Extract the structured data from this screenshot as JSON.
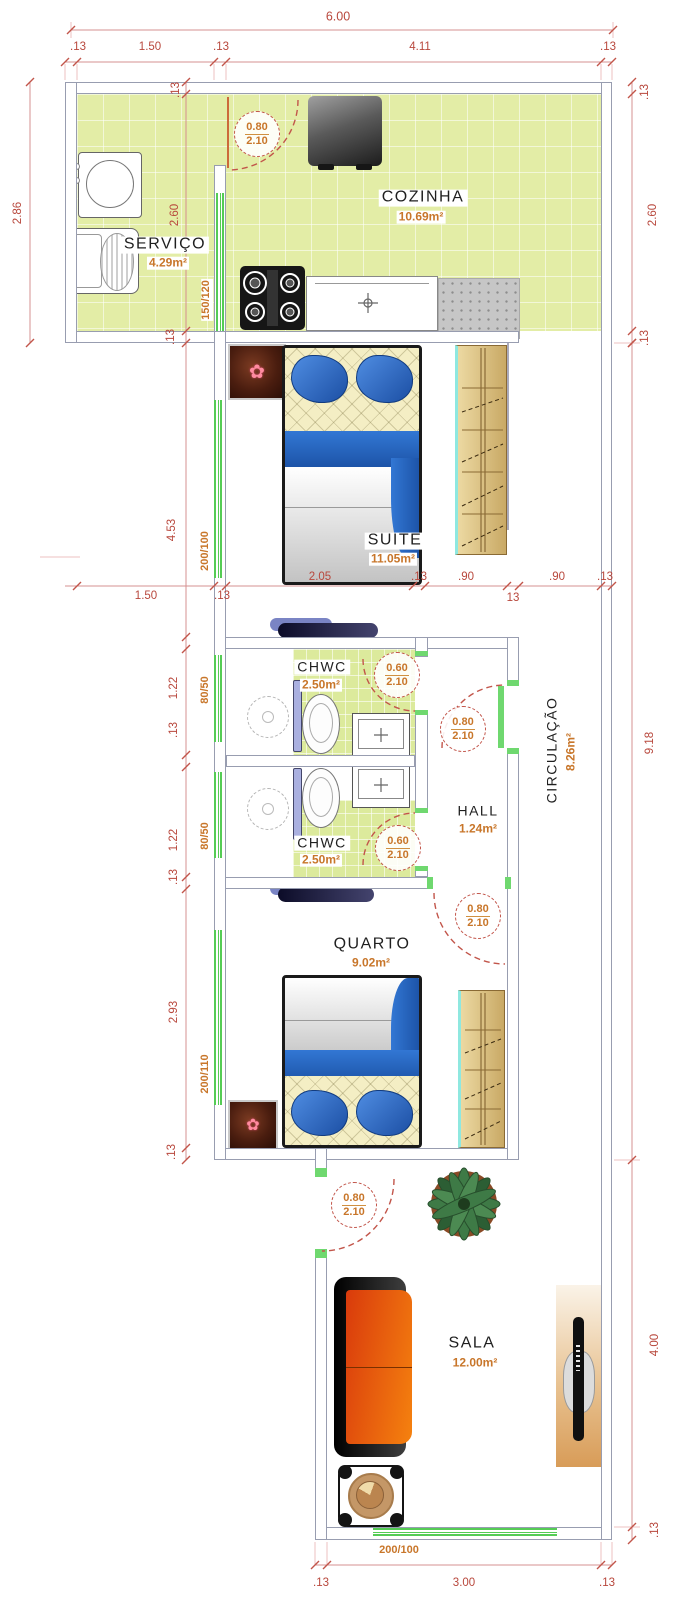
{
  "rooms": {
    "servico": {
      "name": "SERVIÇO",
      "area": "4.29m²"
    },
    "cozinha": {
      "name": "COZINHA",
      "area": "10.69m²"
    },
    "suite": {
      "name": "SUITE",
      "area": "11.05m²"
    },
    "chwc1": {
      "name": "CHWC",
      "area": "2.50m²"
    },
    "chwc2": {
      "name": "CHWC",
      "area": "2.50m²"
    },
    "hall": {
      "name": "HALL",
      "area": "1.24m²"
    },
    "circulacao": {
      "name": "CIRCULAÇÃO",
      "area": "8.26m²"
    },
    "quarto": {
      "name": "QUARTO",
      "area": "9.02m²"
    },
    "sala": {
      "name": "SALA",
      "area": "12.00m²"
    }
  },
  "doors": {
    "kitchen": {
      "w": "0.80",
      "h": "2.10"
    },
    "chwc1": {
      "w": "0.60",
      "h": "2.10"
    },
    "hall": {
      "w": "0.80",
      "h": "2.10"
    },
    "chwc2": {
      "w": "0.60",
      "h": "2.10"
    },
    "quarto": {
      "w": "0.80",
      "h": "2.10"
    },
    "sala": {
      "w": "0.80",
      "h": "2.10"
    }
  },
  "windows": {
    "servico_cozinha": "150/120",
    "suite": "200/100",
    "chwc1": "80/50",
    "chwc2": "80/50",
    "quarto": "200/110",
    "sala": "200/100"
  },
  "dims": {
    "top": [
      "6.00",
      ".13",
      "1.50",
      ".13",
      "4.11",
      ".13"
    ],
    "left": [
      "2.86",
      ".13",
      "2.60",
      ".13",
      "4.53",
      "1.22",
      ".13",
      "1.22",
      ".13",
      "2.93",
      ".13"
    ],
    "right": [
      ".13",
      "2.60",
      ".13",
      "9.18",
      "4.00",
      ".13"
    ],
    "middle": [
      "2.05",
      ".13",
      ".90",
      ".90",
      ".13",
      "1.50",
      ".13",
      "13"
    ],
    "bottom": [
      ".13",
      "3.00",
      ".13"
    ]
  },
  "icons": {
    "flower": "✿"
  },
  "colors": {
    "floor": "#e3eda6",
    "dim_text": "#b8473c",
    "accent_text": "#c8762a",
    "window": "#55cc55",
    "door_arc": "#c2554a",
    "wall_line": "#989db0"
  }
}
